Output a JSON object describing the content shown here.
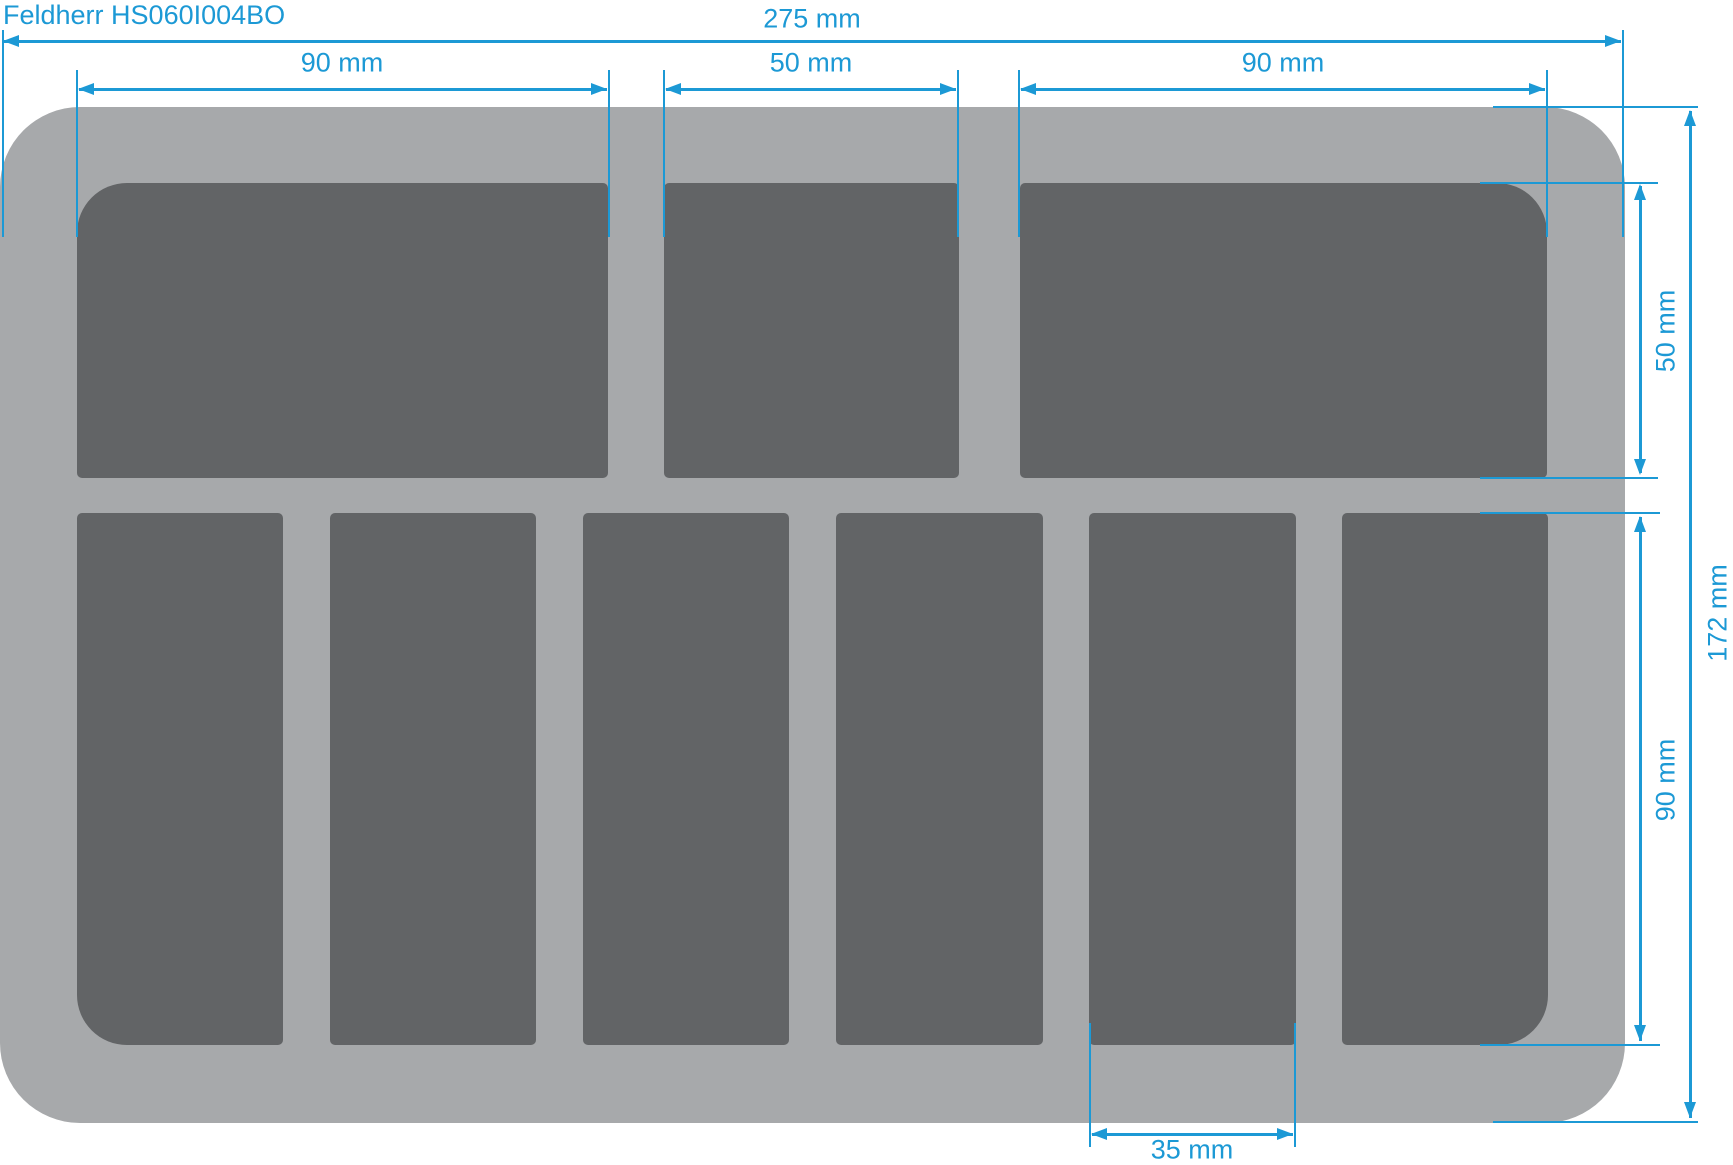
{
  "title": "Feldherr HS060I004BO",
  "colors": {
    "background": "#ffffff",
    "tray": "#a7a9ab",
    "compartment": "#626466",
    "annotation": "#1c99d5"
  },
  "tray": {
    "top_row_compartments": 3,
    "bottom_row_compartments": 6
  },
  "dimensions": {
    "total_width": {
      "label": "275 mm",
      "value_mm": 275
    },
    "top_left_width": {
      "label": "90 mm",
      "value_mm": 90
    },
    "top_middle_width": {
      "label": "50 mm",
      "value_mm": 50
    },
    "top_right_width": {
      "label": "90 mm",
      "value_mm": 90
    },
    "top_row_height": {
      "label": "50 mm",
      "value_mm": 50
    },
    "bottom_row_height": {
      "label": "90 mm",
      "value_mm": 90
    },
    "total_height": {
      "label": "172 mm",
      "value_mm": 172
    },
    "bottom_compartment_width": {
      "label": "35 mm",
      "value_mm": 35
    }
  }
}
